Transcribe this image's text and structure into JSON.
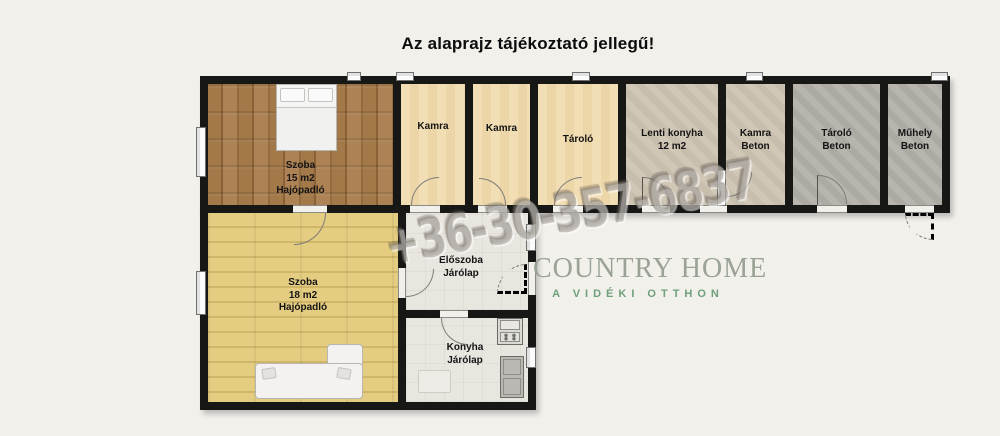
{
  "title": "Az alaprajz tájékoztató jellegű!",
  "watermark": {
    "phone": "+36-30-357-6837"
  },
  "logo": {
    "name": "COUNTRY HOME",
    "tagline": "A VIDÉKI OTTHON"
  },
  "rooms": [
    {
      "name": "Szoba",
      "area": "15 m2",
      "floor": "Hajópadló"
    },
    {
      "name": "Kamra"
    },
    {
      "name": "Kamra"
    },
    {
      "name": "Tároló"
    },
    {
      "name": "Lenti konyha",
      "area": "12 m2"
    },
    {
      "name": "Kamra",
      "floor": "Beton"
    },
    {
      "name": "Tároló",
      "floor": "Beton"
    },
    {
      "name": "Műhely",
      "floor": "Beton"
    },
    {
      "name": "Szoba",
      "area": "18 m2",
      "floor": "Hajópadló"
    },
    {
      "name": "Előszoba",
      "floor": "Járólap"
    },
    {
      "name": "Konyha",
      "floor": "Járólap"
    }
  ],
  "colors": {
    "background": "#f2f0eb",
    "wall": "#171716",
    "floor_wood_dark": "#9e7849",
    "floor_wood_light": "#e2cb7d",
    "floor_cream": "#f1daab",
    "floor_beton_light": "#cec4b3",
    "floor_beton": "#b4b1ab",
    "floor_tile": "#e9e6e0",
    "logo_green": "#6fa07c",
    "logo_gray": "#9aa396",
    "watermark_gray": "#7e786d"
  }
}
